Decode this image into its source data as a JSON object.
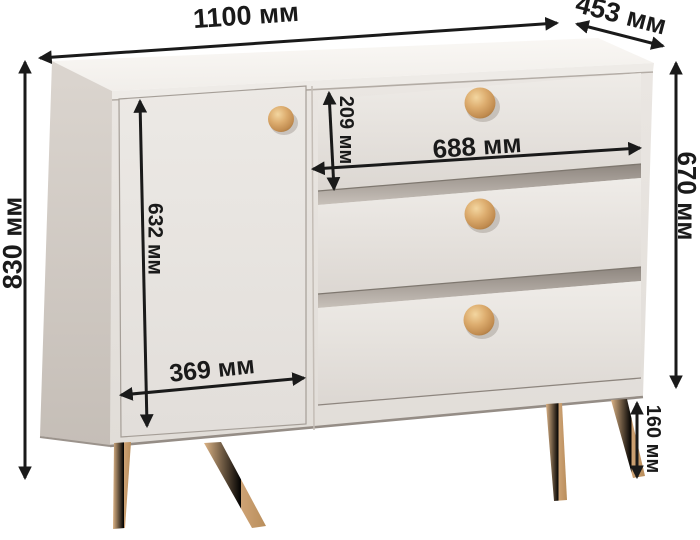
{
  "diagram": {
    "subject": "dresser-with-door-and-three-drawers",
    "unit": "мм",
    "colors": {
      "background": "#ffffff",
      "arrow": "#1a1a1a",
      "cabinet_top": "#f8f6f3",
      "cabinet_side": "#d2cbc4",
      "cabinet_front": "#e7e3df",
      "drawer_front": "#eae6e2",
      "knob_wood": "#d8a96b",
      "leg_wood": "#cfa573"
    },
    "dimensions": {
      "top_width": {
        "value": 1100,
        "unit": "мм",
        "label": "1100 мм"
      },
      "top_depth": {
        "value": 453,
        "unit": "мм",
        "label": "453 мм"
      },
      "overall_height": {
        "value": 830,
        "unit": "мм",
        "label": "830 мм"
      },
      "body_height": {
        "value": 670,
        "unit": "мм",
        "label": "670 мм"
      },
      "door_height": {
        "value": 632,
        "unit": "мм",
        "label": "632 мм"
      },
      "top_drawer_height": {
        "value": 209,
        "unit": "мм",
        "label": "209 мм"
      },
      "drawer_width": {
        "value": 688,
        "unit": "мм",
        "label": "688 мм"
      },
      "door_width": {
        "value": 369,
        "unit": "мм",
        "label": "369 мм"
      },
      "leg_height": {
        "value": 160,
        "unit": "мм",
        "label": "160 мм"
      }
    }
  }
}
